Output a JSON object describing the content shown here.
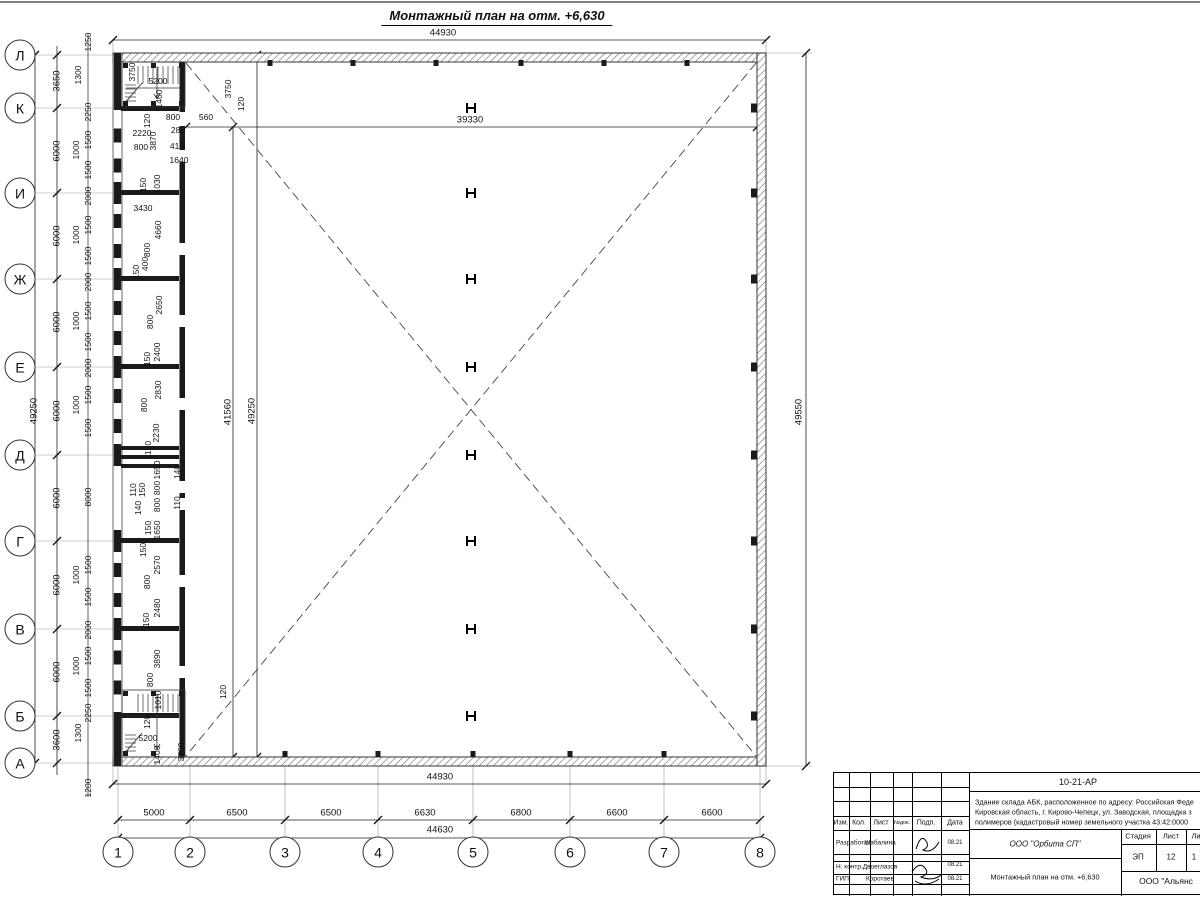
{
  "page_title": "Монтажный план на отм. +6,630",
  "axes": {
    "rows": [
      "Л",
      "К",
      "И",
      "Ж",
      "Е",
      "Д",
      "Г",
      "В",
      "Б",
      "А"
    ],
    "cols": [
      "1",
      "2",
      "3",
      "4",
      "5",
      "6",
      "7",
      "8"
    ]
  },
  "dims": {
    "top_overall": "44930",
    "bottom_overall": "44930",
    "inner_width": "39330",
    "inner_height": "41560",
    "inner_total_height": "49250",
    "left_total": "49250",
    "right_total": "49550",
    "col_total": "44630",
    "col_spacings": [
      "5000",
      "6500",
      "6500",
      "6630",
      "6800",
      "6600",
      "6600"
    ],
    "row_spacings": [
      "3650",
      "6000",
      "6000",
      "6000",
      "6000",
      "6000",
      "6000",
      "6000",
      "3600"
    ],
    "left_detail": [
      "1250",
      "1300",
      "2250",
      "1500",
      "1000",
      "1500",
      "2000",
      "1500",
      "1000",
      "1500",
      "2000",
      "1500",
      "1000",
      "1500",
      "2000",
      "1500",
      "1000",
      "1500",
      "8000",
      "1500",
      "1000",
      "1500",
      "2000",
      "1500",
      "1000",
      "1500",
      "2250",
      "1300",
      "1200"
    ],
    "plan_detail": [
      "3750",
      "5200",
      "1400",
      "120",
      "800",
      "280",
      "2220",
      "800",
      "3870",
      "410",
      "1640",
      "560",
      "3750",
      "120",
      "150",
      "1030",
      "3430",
      "4660",
      "800",
      "400",
      "150",
      "2650",
      "800",
      "2400",
      "150",
      "2830",
      "800",
      "2230",
      "150",
      "1650",
      "140",
      "110",
      "150",
      "800",
      "800",
      "140",
      "110",
      "150",
      "1650",
      "150",
      "2570",
      "800",
      "2480",
      "150",
      "3890",
      "800",
      "1010",
      "120",
      "5200",
      "1400",
      "3700",
      "120"
    ]
  },
  "titleblock": {
    "doc_number": "10-21-АР",
    "description_line1": "Здание склада АБК, расположенное по адресу: Российская Феде",
    "description_line2": "Кировская область, г. Кирово-Чепецк, ул. Заводская, площадка з",
    "description_line3": "полимеров (кадастровый номер земельного участка 43:42:0000",
    "header": {
      "izm": "Изм.",
      "kol": "Кол.",
      "list": "Лист",
      "ndoc": "№док.",
      "podp": "Подп.",
      "data": "Дата"
    },
    "rows": [
      {
        "role": "Разработал",
        "name": "Шабалина",
        "date": "08.21"
      },
      {
        "role": "Н. контр.",
        "name": "Двоеглазов",
        "date": "08.21"
      },
      {
        "role": "ГИП",
        "name": "Коротаев",
        "date": "08.21"
      }
    ],
    "stage_label": "Стадия",
    "sheet_label": "Лист",
    "sheets_label": "Ли",
    "stage": "ЭП",
    "sheet": "12",
    "sheets": "1",
    "org": "ООО \"Орбита СП\"",
    "drawing_title": "Монтажный план на отм. +6,630",
    "org2": "ООО \"Альянс"
  }
}
